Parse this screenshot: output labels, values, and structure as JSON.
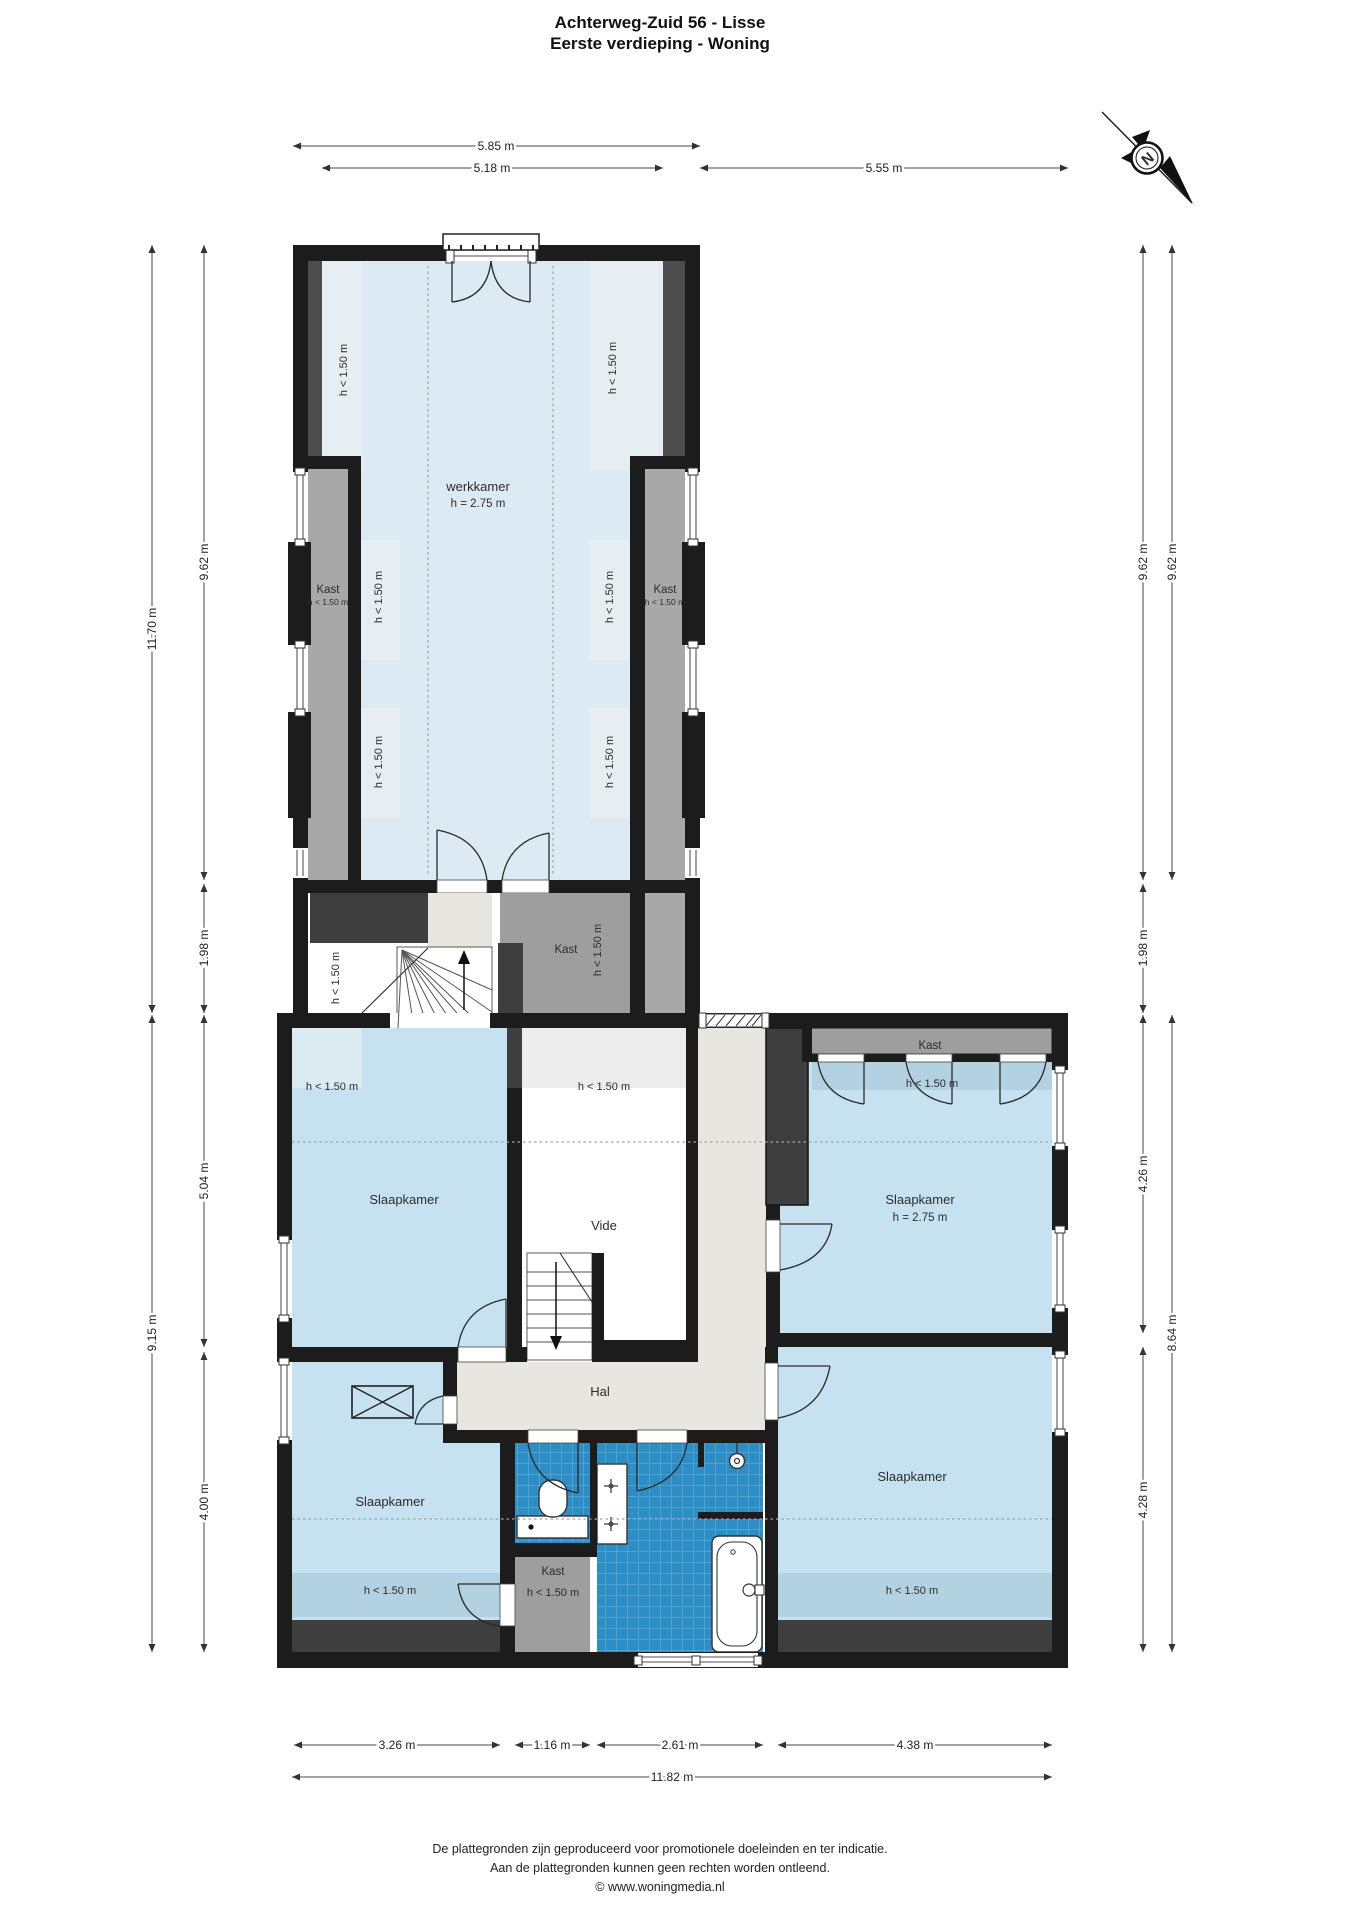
{
  "title": {
    "line1": "Achterweg-Zuid 56 - Lisse",
    "line2": "Eerste verdieping - Woning"
  },
  "compass": {
    "north": "N"
  },
  "labels": {
    "werkkamer": "werkkamer",
    "slaapkamer": "Slaapkamer",
    "vide": "Vide",
    "hal": "Hal",
    "kast": "Kast",
    "height_275": "h = 2.75 m",
    "height_low": "h < 1.50 m"
  },
  "dimensions": {
    "top": [
      "5.85 m",
      "5.18 m",
      "5.55 m"
    ],
    "left": [
      "11.70 m",
      "9.62 m",
      "1.98 m",
      "9.15 m",
      "5.04 m",
      "4.00 m"
    ],
    "right": [
      "9.62 m",
      "9.62 m",
      "1.98 m",
      "4.26 m",
      "8.64 m",
      "4.28 m"
    ],
    "bottom": [
      "3.26 m",
      "1.16 m",
      "2.61 m",
      "4.38 m",
      "11.82 m"
    ]
  },
  "footer": {
    "line1": "De plattegronden zijn geproduceerd voor promotionele doeleinden en ter indicatie.",
    "line2": "Aan de plattegronden kunnen geen rechten worden ontleend.",
    "line3": "© www.woningmedia.nl"
  },
  "colors": {
    "wall": "#1c1c1c",
    "room_blue": "#c6e2f0",
    "werkkamer_blue": "#dcebf3",
    "tile_blue": "#2d8ec6",
    "closet_gray": "#9e9e9e",
    "hall_beige": "#e8e6e0",
    "accent_dark": "#3e3e3e"
  }
}
